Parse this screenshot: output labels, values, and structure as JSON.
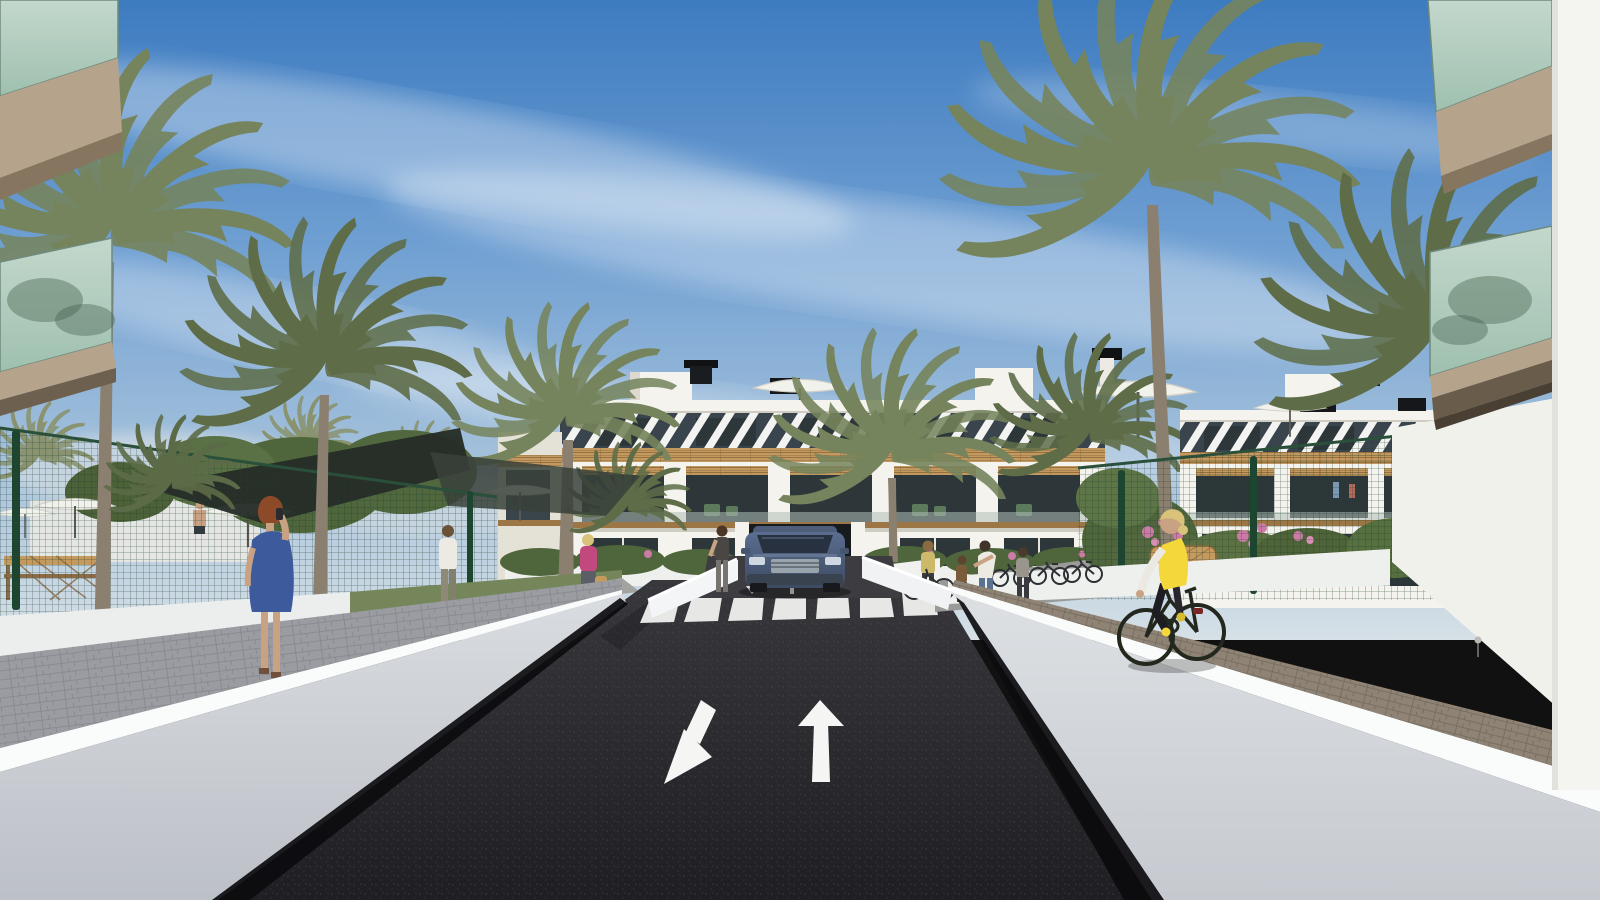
{
  "scene": {
    "description": "Photorealistic architectural render of a residential complex: a dark asphalt driveway with a white straight-ahead arrow and a diagonal exit arrow leads to a zebra crosswalk and an underground parking ramp where a blue SUV exits a three-storey white apartment building with diagonal-slat attic band, timber trim and glazed balconies. Tall palm trees, green mesh fences, white ramp walls, a woman in a blue dress on a phone, a cyclist in a yellow vest, and pedestrians under a blue sky with wispy clouds.",
    "objects": [
      "sky",
      "clouds",
      "central-apartment-building",
      "right-apartment-building",
      "left-foreground-balconies",
      "right-foreground-balconies",
      "palm-trees",
      "green-mesh-fence",
      "shade-sail",
      "pool-parasols",
      "asphalt-road",
      "zebra-crosswalk",
      "straight-arrow-marking",
      "diagonal-arrow-marking",
      "parking-ramp",
      "blue-suv",
      "woman-blue-dress",
      "cyclist-yellow-vest",
      "pedestrians",
      "bicycle-racks",
      "wicker-bench",
      "flower-bushes"
    ],
    "road_markings": {
      "lane_toward_viewer": "diagonal-arrow-marking",
      "lane_away_from_viewer": "straight-arrow-marking",
      "crosswalk_stripes": 7
    }
  },
  "palette": {
    "sky_top": "#3d7bc0",
    "sky_mid": "#6f9fd2",
    "sky_low": "#a9c4dc",
    "sky_horizon": "#d6e0e6",
    "cloud": "#ffffff",
    "building_white": "#f4f3ee",
    "building_shade": "#e4e1d7",
    "parapet_shadow": "#cfccc2",
    "slat_dark": "#3a444c",
    "wood": "#c29960",
    "wood_dark": "#9c7645",
    "window_dark": "#2d3739",
    "glass_balcony": "#9fc0af",
    "glass_edge": "#74907f",
    "soffit_tan": "#b5a38b",
    "soffit_dark": "#86765f",
    "fence_green": "#25503b",
    "fence_post": "#1e4530",
    "palm_green": "#75845c",
    "palm_dark": "#5e6d48",
    "palm_distant": "#8a9370",
    "trunk_brown": "#8b7f6f",
    "grass_green": "#74865a",
    "bush_green": "#4f663c",
    "flower_pink": "#cc7ba6",
    "wall_light": "#d6d9dd",
    "wall_mid": "#c2c6cc",
    "coping_white": "#fafbfb",
    "base_shadow": "#0c0c0f",
    "paver_left": "#9b9ca1",
    "paver_right": "#8e8374",
    "asphalt_top": "#37373c",
    "asphalt_bottom": "#1f1f23",
    "marking_white": "#f5f5f3",
    "car_body": "#5b6e90",
    "car_dark": "#3c4a62",
    "car_glass": "#28313f",
    "skin": "#c9a183",
    "hair_auburn": "#8c4a28",
    "dress_blue": "#3d5a9c",
    "vest_yellow": "#f4d73a",
    "shade_sail": "#262d28",
    "parasol_white": "#f2f2ec",
    "wicker_tan": "#c59a5e",
    "denim_blue": "#5b7191",
    "top_white": "#eceae3",
    "top_pink": "#c2497e"
  }
}
